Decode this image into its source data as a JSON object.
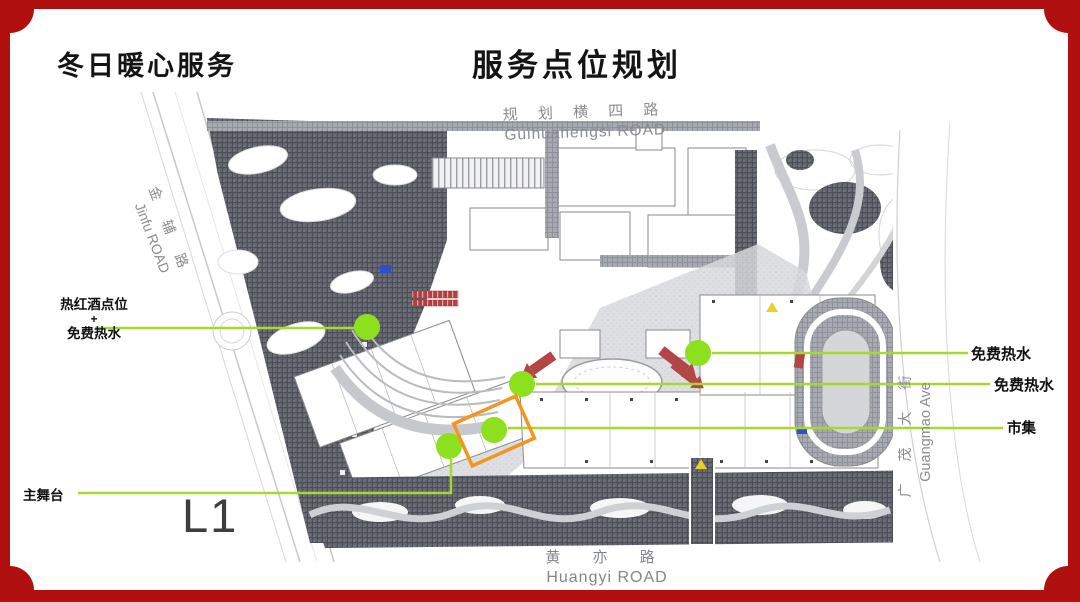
{
  "titles": {
    "left": "冬日暖心服务",
    "center": "服务点位规划"
  },
  "floor_label": "L1",
  "roads": {
    "top": {
      "cn": "规 划 横 四 路",
      "en": "Guihuahengsi ROAD"
    },
    "left": {
      "cn": "金 辅 路",
      "en": "Jinfu ROAD"
    },
    "right": {
      "cn": "广 茂 大 街",
      "en": "Guangmao Ave"
    },
    "bottom": {
      "cn": "黄  亦  路",
      "en": "Huangyi ROAD"
    }
  },
  "callouts": {
    "wine_point": {
      "line1": "热红酒点位",
      "line2": "+",
      "line3": "免费热水"
    },
    "main_stage": "主舞台",
    "hot_water_1": "免费热水",
    "hot_water_2": "免费热水",
    "market": "市集"
  },
  "colors": {
    "frame_red": "#b01010",
    "marker_green": "#8de01e",
    "line_green": "#a5da2d",
    "highlight_orange": "#f5941f",
    "arrow_red": "#b34545",
    "road_text_gray": "#8b8c90"
  }
}
